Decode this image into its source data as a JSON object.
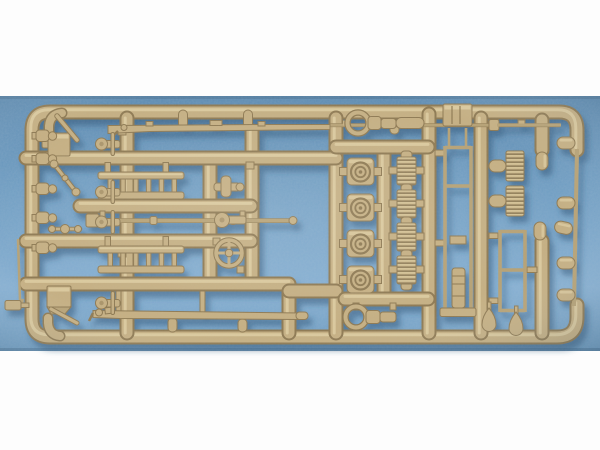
{
  "image": {
    "description": "Photograph of a tan plastic model kit sprue (injection-molded parts runner) lying on a blue textured cloth board, letterboxed with white margins above and below",
    "subject": "model kit parts sprue",
    "material": "tan/beige styrene plastic",
    "background_surface": "blue textured board"
  },
  "colors": {
    "white_bg": "#fdfdfd",
    "blue_mid": "#6f9dc2",
    "blue_dark": "#5d8bb1",
    "blue_light": "#85afd2",
    "plastic_mid": "#c6b083",
    "plastic_dark": "#8f7a52",
    "plastic_hi": "#e4d4a8",
    "plastic_thin": "#b7a274",
    "shadow_blue": "#2c4f70"
  },
  "sprue": {
    "layout": "rectangular runner frame with internal vertical and horizontal runners",
    "parts": [
      {
        "name": "long rifle-shaped rod",
        "count": 2
      },
      {
        "name": "assembly ladder",
        "count": 2
      },
      {
        "name": "hose reel drum",
        "count": 4
      },
      {
        "name": "corrugated hose section",
        "count": 6
      },
      {
        "name": "narrow ladder rack frame",
        "count": 2
      },
      {
        "name": "tow shackle with ring",
        "count": 2
      },
      {
        "name": "square hatch plate",
        "count": 2
      },
      {
        "name": "equipment box",
        "count": 1
      },
      {
        "name": "screw jack",
        "count": 1
      },
      {
        "name": "long pole",
        "count": 1
      },
      {
        "name": "hand wheel",
        "count": 1
      },
      {
        "name": "elbow pipe",
        "count": 2
      },
      {
        "name": "flask or canister",
        "count": 5
      },
      {
        "name": "valve fitting",
        "count": 4
      },
      {
        "name": "bullet-shaped capsule",
        "count": 7
      },
      {
        "name": "teardrop weight",
        "count": 2
      },
      {
        "name": "small hand tool",
        "count": 4
      },
      {
        "name": "handrail rod",
        "count": 1
      }
    ]
  }
}
